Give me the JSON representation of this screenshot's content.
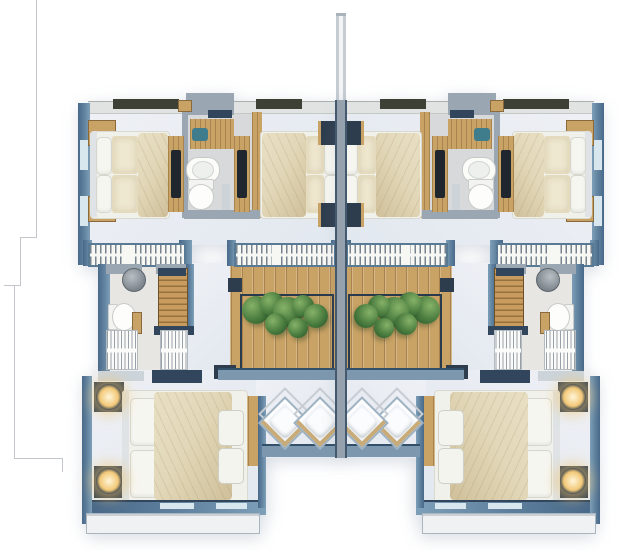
{
  "palette": {
    "wall_blue": "#5d7f9c",
    "wall_navy": "#31465c",
    "wall_gray": "#9aa7b2",
    "wall_light": "#ccd4da",
    "floor_light": "#eef0f5",
    "floor_cool": "#e2e8ef",
    "bath_floor": "#d7d9da",
    "wood": "#c9a265",
    "stair_wood": "#c89c5e",
    "olive_parapet": "#3d4034",
    "plant_green": "#4a7c3f",
    "plant_green_dark": "#2e5c2d",
    "lamp_glow": "#f2c878",
    "bed_duvet": "#e2d7b8",
    "bed_duvet_dark": "#cfc09a",
    "pillow_white": "#f6f6f1",
    "teal_sink": "#3f7d8c",
    "railing_white": "#f7f7f4",
    "ledge_white": "#f0f1f3",
    "boundary_line": "#c2c6cb"
  },
  "plan": {
    "type": "residential-floor-plan",
    "units": [
      {
        "id": "unit-left",
        "mirrored": false
      },
      {
        "id": "unit-right",
        "mirrored": true
      }
    ],
    "rooms_per_unit": [
      "bedroom-outer",
      "bathroom",
      "bedroom-inner",
      "dressing-room",
      "wc",
      "stairs",
      "balcony-with-planter",
      "master-bedroom",
      "lounge-terrace"
    ],
    "furniture_counts_per_unit": {
      "beds": 3,
      "toilets": 2,
      "sinks": 2,
      "vanities": 1,
      "wardrobe_racks": 2,
      "lounge_chairs": 2,
      "nightstand_lamps": 2,
      "railing_panels": 2,
      "planter_boxes": 1
    },
    "plants": [
      {
        "cx": 256,
        "cy": 310,
        "r": 14
      },
      {
        "cx": 272,
        "cy": 304,
        "r": 12
      },
      {
        "cx": 288,
        "cy": 312,
        "r": 15
      },
      {
        "cx": 303,
        "cy": 306,
        "r": 11
      },
      {
        "cx": 316,
        "cy": 316,
        "r": 12
      },
      {
        "cx": 276,
        "cy": 324,
        "r": 11
      },
      {
        "cx": 298,
        "cy": 328,
        "r": 10
      }
    ],
    "lounge_chairs": [
      {
        "cx": 283,
        "cy": 421
      },
      {
        "cx": 318,
        "cy": 421
      }
    ],
    "lamps": [
      {
        "x": 96,
        "y": 384
      },
      {
        "x": 96,
        "y": 468
      }
    ]
  }
}
